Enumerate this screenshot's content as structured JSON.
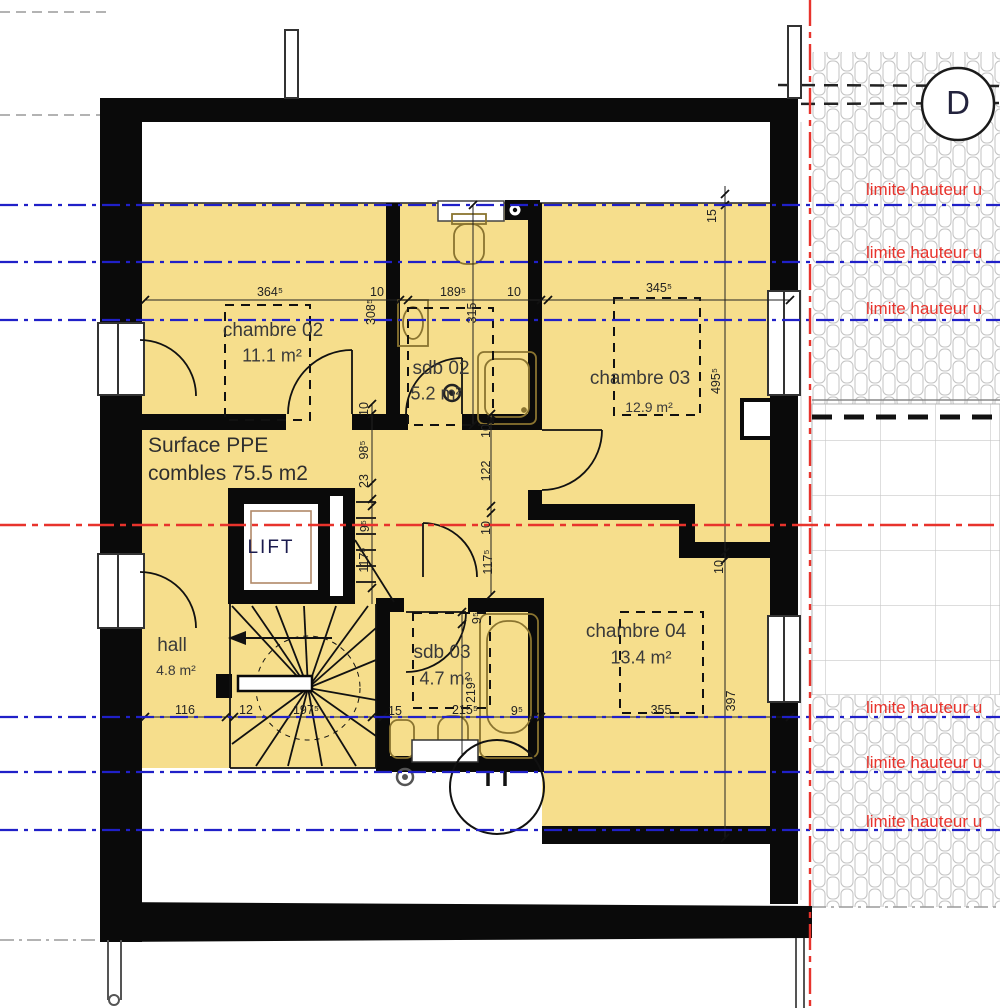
{
  "section_marker": {
    "label": "D"
  },
  "limits": {
    "label": "limite hauteur u"
  },
  "surface": {
    "line1": "Surface PPE",
    "line2": "combles 75.5 m2"
  },
  "rooms": {
    "chambre02": {
      "name": "chambre 02",
      "area": "11.1 m²"
    },
    "chambre03": {
      "name": "chambre 03",
      "area": "12.9 m²"
    },
    "chambre04": {
      "name": "chambre 04",
      "area": "13.4 m²"
    },
    "sdb02": {
      "name": "sdb 02",
      "area": "5.2 m²"
    },
    "sdb03": {
      "name": "sdb 03",
      "area": "4.7 m²"
    },
    "hall": {
      "name": "hall",
      "area": "4.8 m²"
    },
    "lift": {
      "name": "LIFT"
    }
  },
  "dims": {
    "top": [
      {
        "t": "364⁵"
      },
      {
        "t": "10"
      },
      {
        "t": "189⁵"
      },
      {
        "t": "10"
      },
      {
        "t": "345⁵"
      }
    ],
    "bottom": [
      {
        "t": "116"
      },
      {
        "t": "12"
      },
      {
        "t": "197⁵"
      },
      {
        "t": "15"
      },
      {
        "t": "215⁵"
      },
      {
        "t": "9⁵"
      },
      {
        "t": "355"
      }
    ],
    "vertical": [
      {
        "t": "308⁵"
      },
      {
        "t": "315"
      },
      {
        "t": "15"
      },
      {
        "t": "495⁵"
      },
      {
        "t": "10"
      },
      {
        "t": "397"
      },
      {
        "t": "10"
      },
      {
        "t": "98⁵"
      },
      {
        "t": "23"
      },
      {
        "t": "9⁵"
      },
      {
        "t": "117⁵"
      },
      {
        "t": "10"
      },
      {
        "t": "122"
      },
      {
        "t": "10"
      },
      {
        "t": "117⁵"
      },
      {
        "t": "9⁵"
      },
      {
        "t": "219⁵"
      }
    ]
  },
  "colors": {
    "floor_fill": "#F6DE8C",
    "limit_red": "#E8332C",
    "axis_blue": "#2020C8",
    "wall_black": "#0A0A0A"
  }
}
